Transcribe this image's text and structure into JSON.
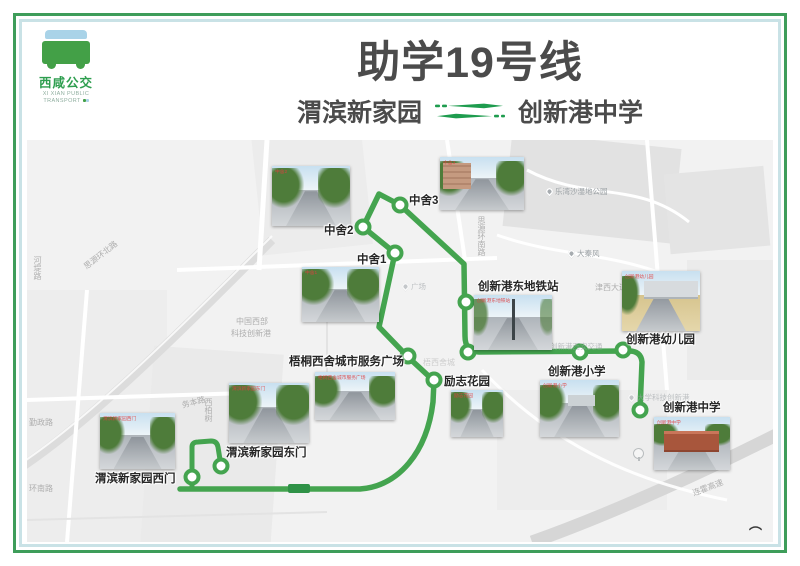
{
  "header": {
    "logo": {
      "cn": "西咸公交",
      "en_line1": "XI XIAN PUBLIC",
      "en_line2": "TRANSPORT"
    },
    "title": "助学19号线",
    "origin": "渭滨新家园",
    "destination": "创新港中学"
  },
  "colors": {
    "route_green": "#44a44f",
    "border_green": "#3e9d5a",
    "border_blue": "#c9e2e6",
    "map_bg": "#f2f2f2",
    "accent_green": "#1e9c4e"
  },
  "map": {
    "route_path": "M153 349 L333 349 C372 346 400 312 406 262 L407 241 L381 217 L352 187 L368 113 L336 87 L352 54 L373 65 L437 124 L438 196 Q438 212 452 212 L602 211 Q614 211 615 222 L613 270",
    "spur_path": "M165 349 L165 307 Q165 302 171 302 L184 301 Q190 301 191 307 L194 326",
    "badge": {
      "x": 261,
      "y": 344,
      "w": 22,
      "h": 9
    },
    "extra_rings": [
      {
        "x": 441,
        "y": 212
      }
    ],
    "stops": [
      {
        "name": "渭滨新家园西门",
        "cx": 165,
        "cy": 337,
        "label": {
          "x": 68,
          "y": 330
        },
        "photo": {
          "x": 73,
          "y": 273,
          "w": 75,
          "h": 56,
          "variant": "street"
        }
      },
      {
        "name": "渭滨新家园东门",
        "cx": 194,
        "cy": 326,
        "label": {
          "x": 199,
          "y": 304
        },
        "photo": {
          "x": 202,
          "y": 243,
          "w": 80,
          "h": 60,
          "variant": "street-trees"
        }
      },
      {
        "name": "励志花园",
        "cx": 407,
        "cy": 240,
        "label": {
          "x": 417,
          "y": 233
        },
        "photo": {
          "x": 424,
          "y": 250,
          "w": 52,
          "h": 47,
          "variant": "street-trees"
        }
      },
      {
        "name": "梧桐西舍城市服务广场",
        "cx": 381,
        "cy": 216,
        "label": {
          "x": 262,
          "y": 213
        },
        "photo": {
          "x": 288,
          "y": 232,
          "w": 80,
          "h": 48,
          "variant": "street"
        }
      },
      {
        "name": "中舍1",
        "cx": 368,
        "cy": 113,
        "label": {
          "x": 330,
          "y": 111
        },
        "photo": {
          "x": 275,
          "y": 127,
          "w": 77,
          "h": 55,
          "variant": "street-trees"
        }
      },
      {
        "name": "中舍2",
        "cx": 336,
        "cy": 87,
        "label": {
          "x": 297,
          "y": 82
        },
        "photo": {
          "x": 245,
          "y": 26,
          "w": 78,
          "h": 60,
          "variant": "street-trees"
        }
      },
      {
        "name": "中舍3",
        "cx": 373,
        "cy": 65,
        "label": {
          "x": 382,
          "y": 52
        },
        "photo": {
          "x": 413,
          "y": 17,
          "w": 84,
          "h": 53,
          "variant": "buildings"
        }
      },
      {
        "name": "创新港东地铁站",
        "cx": 439,
        "cy": 162,
        "label": {
          "x": 451,
          "y": 138
        },
        "photo": {
          "x": 447,
          "y": 155,
          "w": 78,
          "h": 55,
          "variant": "plaza"
        }
      },
      {
        "name": "创新港小学",
        "cx": 553,
        "cy": 212,
        "label": {
          "x": 521,
          "y": 223
        },
        "photo": {
          "x": 513,
          "y": 240,
          "w": 79,
          "h": 57,
          "variant": "school-green"
        }
      },
      {
        "name": "创新港幼儿园",
        "cx": 596,
        "cy": 210,
        "label": {
          "x": 599,
          "y": 191
        },
        "photo": {
          "x": 595,
          "y": 131,
          "w": 78,
          "h": 60,
          "variant": "campus"
        }
      },
      {
        "name": "创新港中学",
        "cx": 613,
        "cy": 270,
        "label": {
          "x": 636,
          "y": 259
        },
        "photo": {
          "x": 627,
          "y": 277,
          "w": 76,
          "h": 53,
          "variant": "school-brick"
        }
      }
    ],
    "road_labels": [
      {
        "text": "河堤路",
        "x": 5,
        "y": 116,
        "vertical": true
      },
      {
        "text": "思源环北路",
        "x": 58,
        "y": 122,
        "rotate": -38
      },
      {
        "text": "勤政路",
        "x": 2,
        "y": 277
      },
      {
        "text": "环南路",
        "x": 2,
        "y": 343
      },
      {
        "text": "务本路",
        "x": 155,
        "y": 260,
        "rotate": -15
      },
      {
        "text": "西柏树",
        "x": 176,
        "y": 258,
        "vertical": true
      },
      {
        "text": "思源环南路",
        "x": 449,
        "y": 76,
        "vertical": true
      },
      {
        "text": "津西大道",
        "x": 568,
        "y": 142
      },
      {
        "text": "连霍高速",
        "x": 666,
        "y": 348,
        "rotate": -21
      },
      {
        "text": "中国西部",
        "x": 209,
        "y": 176
      },
      {
        "text": "科技创新港",
        "x": 204,
        "y": 188
      },
      {
        "text": "梧西舍城",
        "x": 396,
        "y": 217,
        "faint": true
      }
    ],
    "pois": [
      {
        "text": "乐湾沙湿地公园",
        "x": 519,
        "y": 46,
        "pin": true
      },
      {
        "text": "大秦风",
        "x": 541,
        "y": 108,
        "pin": true
      },
      {
        "text": "广场",
        "x": 375,
        "y": 141,
        "pin": true,
        "faint": true
      },
      {
        "text": "创新港西安交通",
        "x": 523,
        "y": 201,
        "pin": false,
        "faint": true
      },
      {
        "text": "大学科技创新港",
        "x": 601,
        "y": 252,
        "pin": true,
        "faint": true
      }
    ],
    "trees": [
      {
        "x": 606,
        "y": 308
      }
    ],
    "corner_mark": "⌒"
  }
}
